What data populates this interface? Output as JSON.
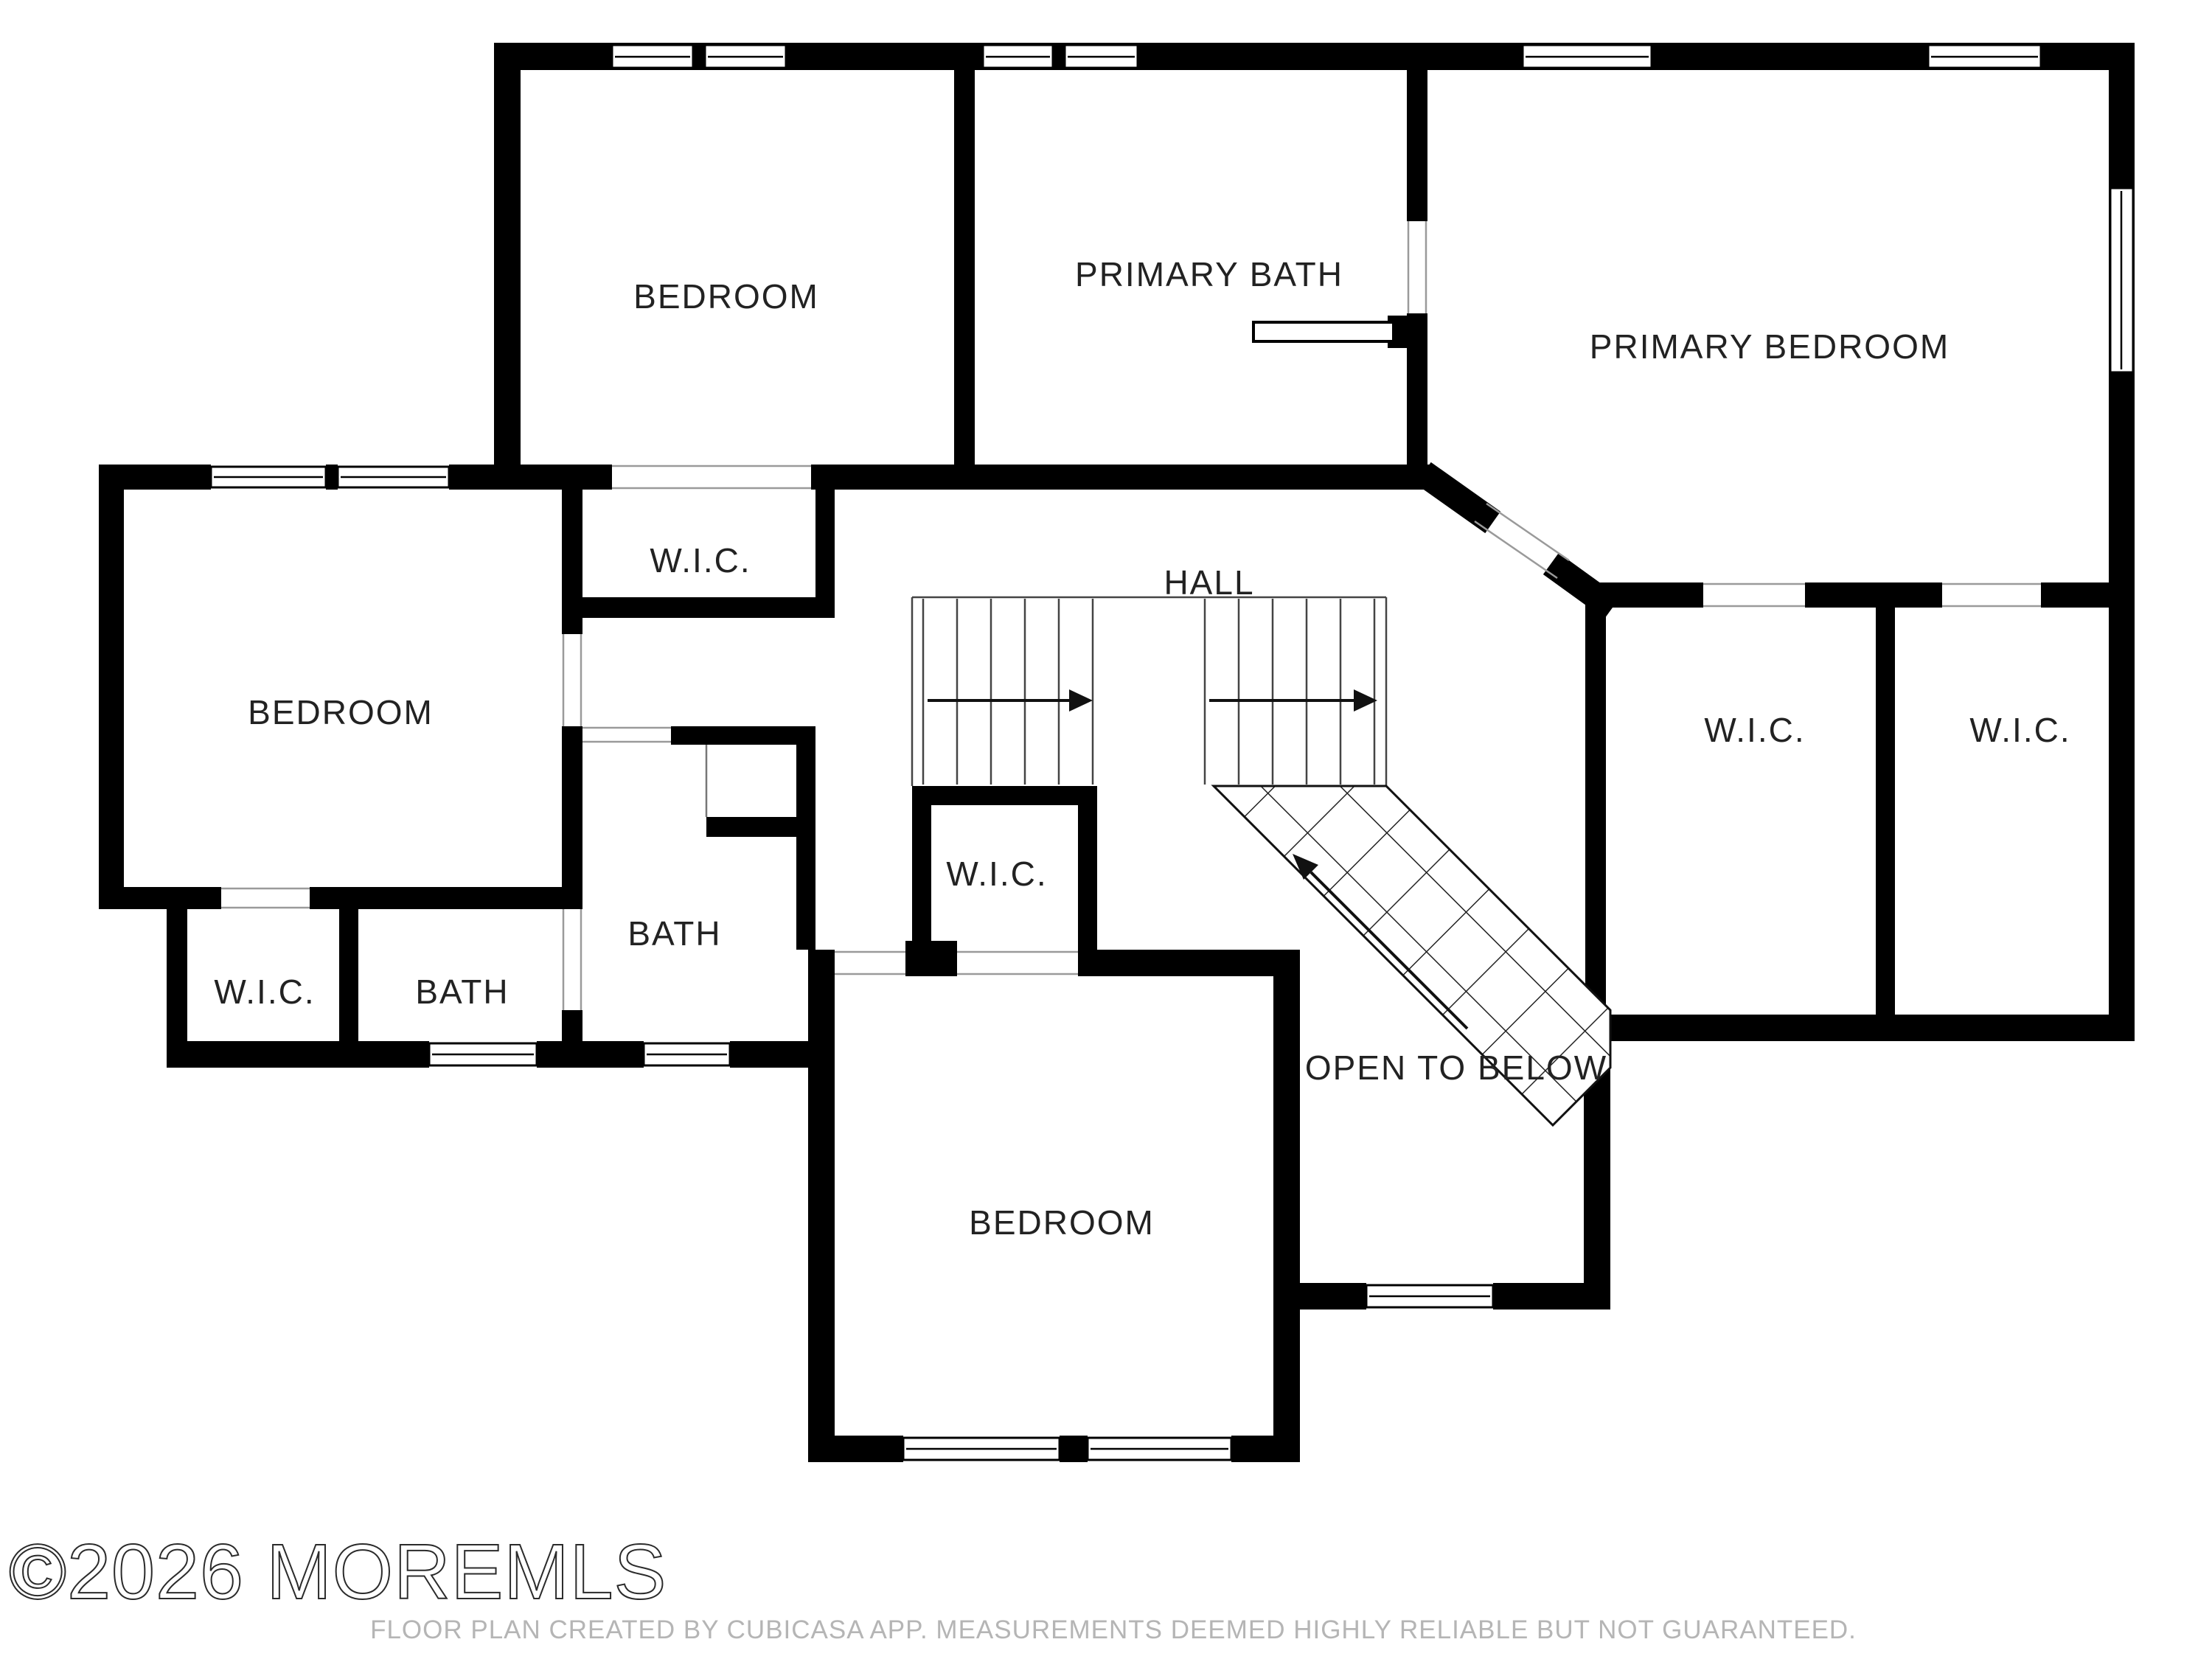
{
  "watermark": "©2026 MOREMLS",
  "footer_disclaimer": "FLOOR PLAN CREATED BY CUBICASA APP. MEASUREMENTS DEEMED HIGHLY RELIABLE BUT NOT GUARANTEED.",
  "colors": {
    "wall": "#000000",
    "background": "#ffffff",
    "label": "#222222",
    "opening_line": "#9a9a9a",
    "stair_line": "#444444",
    "footer_text": "#b5b5b5",
    "watermark_stroke": "#2b2b2b"
  },
  "rooms": {
    "bedroom_top": {
      "label": "BEDROOM"
    },
    "primary_bath": {
      "label": "PRIMARY BATH"
    },
    "primary_bedroom": {
      "label": "PRIMARY BEDROOM"
    },
    "bedroom_left": {
      "label": "BEDROOM"
    },
    "wic_top": {
      "label": "W.I.C."
    },
    "hall": {
      "label": "HALL"
    },
    "wic_right_1": {
      "label": "W.I.C."
    },
    "wic_right_2": {
      "label": "W.I.C."
    },
    "wic_center": {
      "label": "W.I.C."
    },
    "wic_bottom_left": {
      "label": "W.I.C."
    },
    "bath_left": {
      "label": "BATH"
    },
    "bath_middle": {
      "label": "BATH"
    },
    "bedroom_bottom": {
      "label": "BEDROOM"
    },
    "open_to_below": {
      "label": "OPEN TO BELOW"
    }
  }
}
